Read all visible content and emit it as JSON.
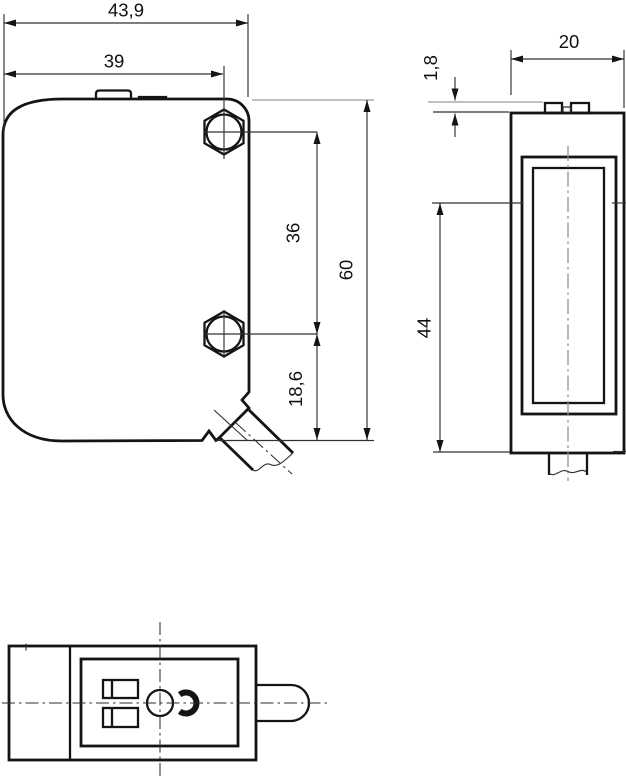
{
  "drawing": {
    "background_color": "#ffffff",
    "line_color": "#141414",
    "centerline_color": "#8d8d8d",
    "dimensions": {
      "front_total_width": "43,9",
      "front_hole_center_width": "39",
      "front_hole_spacing": "36",
      "front_total_height": "60",
      "front_hole_bottom_offset": "18,6",
      "side_depth": "20",
      "side_tab_height": "1,8",
      "side_window_height": "44"
    }
  }
}
